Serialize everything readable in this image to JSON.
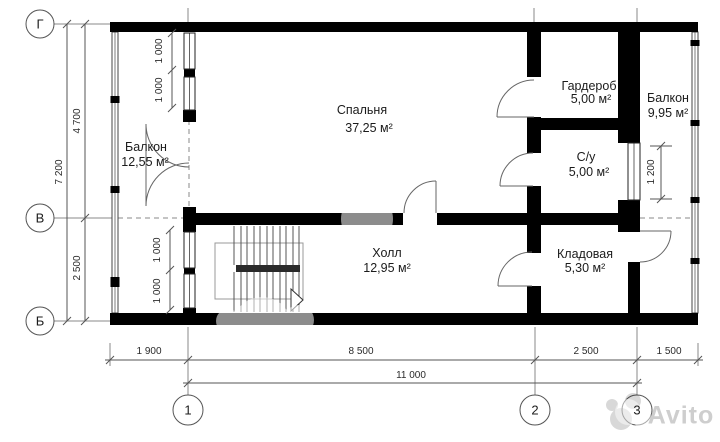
{
  "plan": {
    "rooms": [
      {
        "label": "Балкон",
        "area": "12,55 м²"
      },
      {
        "label": "Спальня",
        "area": "37,25 м²"
      },
      {
        "label": "Гардероб",
        "area": "5,00 м²"
      },
      {
        "label": "Балкон",
        "area": "9,95 м²"
      },
      {
        "label": "С/у",
        "area": "5,00 м²"
      },
      {
        "label": "Холл",
        "area": "12,95 м²"
      },
      {
        "label": "Кладовая",
        "area": "5,30 м²"
      }
    ],
    "axis_markers": {
      "row_top": "Г",
      "row_mid": "В",
      "row_bottom": "Б",
      "col_left": "1",
      "col_mid": "2",
      "col_right": "3"
    },
    "dims": {
      "total_height": "7 200",
      "upper_height": "4 700",
      "lower_height": "2 500",
      "window_top_a": "1 000",
      "window_top_b": "1 000",
      "window_bottom_a": "1 000",
      "window_bottom_b": "1 000",
      "window_right": "1 200",
      "bottom_left": "1 900",
      "bottom_main": "8 500",
      "bottom_mid": "2 500",
      "bottom_right": "1 500",
      "bottom_total": "11 000"
    },
    "watermark": {
      "brand": "Avito"
    }
  }
}
